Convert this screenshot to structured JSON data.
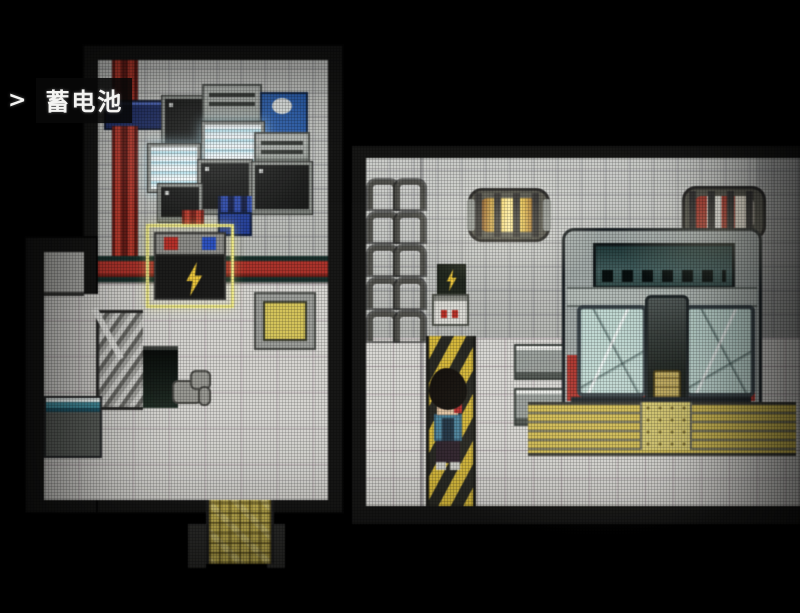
{
  "hud": {
    "cursor": ">",
    "label": "蓄电池"
  },
  "palette": {
    "background": "#000000",
    "wall_tile": "#c6c8c4",
    "floor_tile": "#d6d5d1",
    "pipe_red": "#b23128",
    "hazard_yellow": "#d8b832",
    "highlight_yellow": "#efe97c",
    "train_red": "#b4322a",
    "glass_teal": "#bfd9d3",
    "machine_blue": "#2a62b8",
    "lamp_warm": "#eec23e",
    "battery_bolt_yellow": "#ecc431"
  }
}
